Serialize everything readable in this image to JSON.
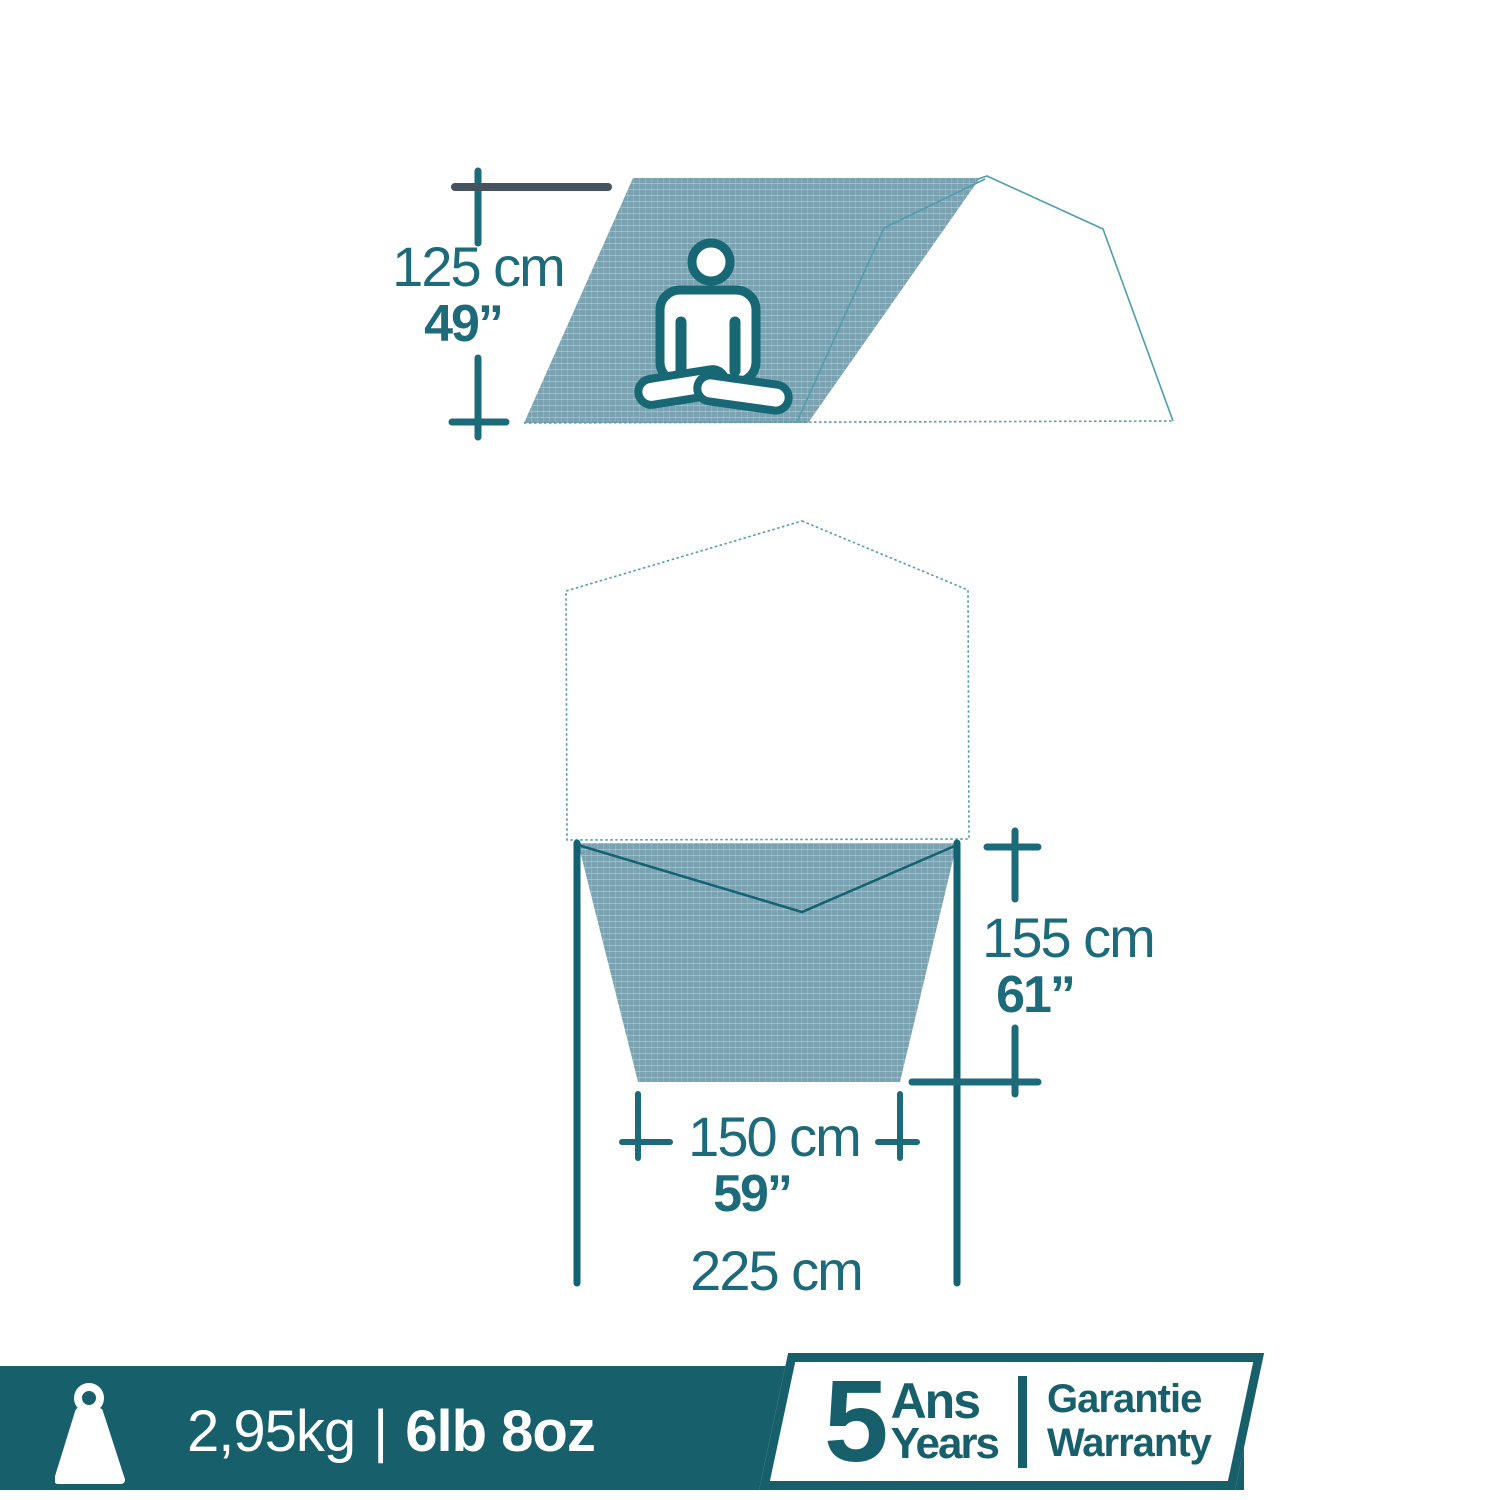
{
  "colors": {
    "accent": "#1d6b7a",
    "accent_dark": "#126273",
    "icon": "#176775",
    "slate": "#45525f",
    "fabric": "#7aa2b0",
    "outline": "#519dac",
    "bar": "#175f6b",
    "white": "#ffffff"
  },
  "side_view": {
    "height_cm": "125 cm",
    "height_in": "49”"
  },
  "top_view": {
    "depth_cm": "155 cm",
    "depth_in": "61”",
    "inner_width_cm": "150 cm",
    "inner_width_in": "59”",
    "total_width_cm": "225 cm"
  },
  "footer": {
    "weight_metric": "2,95kg",
    "separator": "|",
    "weight_imperial": "6lb 8oz"
  },
  "warranty": {
    "number": "5",
    "unit_fr": "Ans",
    "unit_en": "Years",
    "label_fr": "Garantie",
    "label_en": "Warranty"
  }
}
